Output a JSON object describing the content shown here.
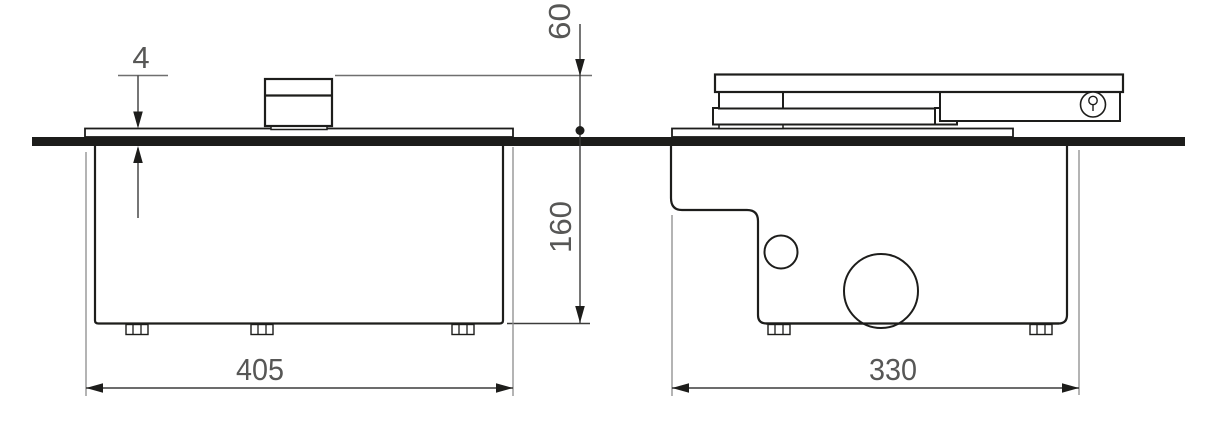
{
  "drawing": {
    "type": "technical-dimension-drawing",
    "background_color": "#ffffff",
    "structure_line_color": "#1d1d1b",
    "dimension_line_color": "#3c3c3b",
    "dimension_text_color": "#575756",
    "floor_line_color": "#1d1d1b",
    "dimensions": {
      "cover_plate_above_floor": "4",
      "unit_height_above_floor": "60",
      "box_depth_below_floor": "160",
      "side_view_box_width": "405",
      "end_view_box_width": "330"
    },
    "icons": {
      "valve_symbol": "circled screw/valve symbol on closer body"
    }
  }
}
